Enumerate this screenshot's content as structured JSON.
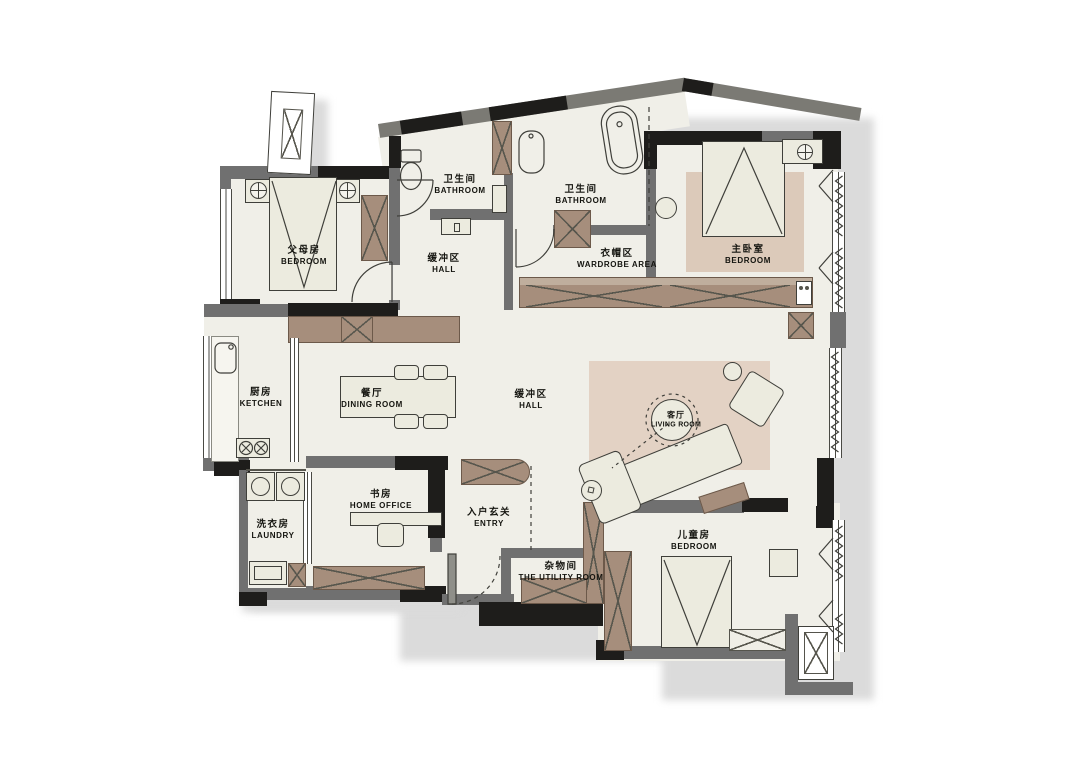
{
  "plan_title": "apartment-floor-plan",
  "rooms": {
    "parents_bedroom": {
      "zh": "父母房",
      "en": "BEDROOM"
    },
    "bathroom_1": {
      "zh": "卫生间",
      "en": "BATHROOM"
    },
    "bathroom_2": {
      "zh": "卫生间",
      "en": "BATHROOM"
    },
    "hall_upper": {
      "zh": "缓冲区",
      "en": "HALL"
    },
    "wardrobe_area": {
      "zh": "衣帽区",
      "en": "WARDROBE AREA"
    },
    "master_bedroom": {
      "zh": "主卧室",
      "en": "BEDROOM"
    },
    "kitchen": {
      "zh": "厨房",
      "en": "KETCHEN"
    },
    "dining_room": {
      "zh": "餐厅",
      "en": "DINING ROOM"
    },
    "hall_center": {
      "zh": "缓冲区",
      "en": "HALL"
    },
    "living_room": {
      "zh": "客厅",
      "en": "LIVING ROOM"
    },
    "laundry": {
      "zh": "洗衣房",
      "en": "LAUNDRY"
    },
    "home_office": {
      "zh": "书房",
      "en": "HOME OFFICE"
    },
    "entry": {
      "zh": "入户玄关",
      "en": "ENTRY"
    },
    "utility_room": {
      "zh": "杂物间",
      "en": "THE UTILITY ROOM"
    },
    "kids_bedroom": {
      "zh": "儿童房",
      "en": "BEDROOM"
    }
  },
  "furniture_icons": [
    "double-bed",
    "single-bed",
    "nightstand-lamp",
    "wardrobe-cabinet",
    "bathtub",
    "toilet",
    "washbasin",
    "dining-table",
    "dining-chair",
    "sofa",
    "armchair",
    "coffee-table",
    "washing-machine",
    "desk",
    "office-chair",
    "kitchen-sink",
    "gas-stove",
    "shoe-cabinet",
    "rug",
    "door-swing",
    "window",
    "radiator-coil",
    "ac-unit",
    "flue-shaft"
  ],
  "colors": {
    "floor": "#f0efe8",
    "wall_gray": "#707070",
    "wall_black": "#1e1d1b",
    "wood_cabinet": "#a68e7c",
    "rug_living": "#e3d2c4",
    "rug_master": "#dccaba",
    "furniture_fill": "#ecebdf",
    "outline": "#3f3f3a",
    "shadow": "#dbdbdb"
  }
}
